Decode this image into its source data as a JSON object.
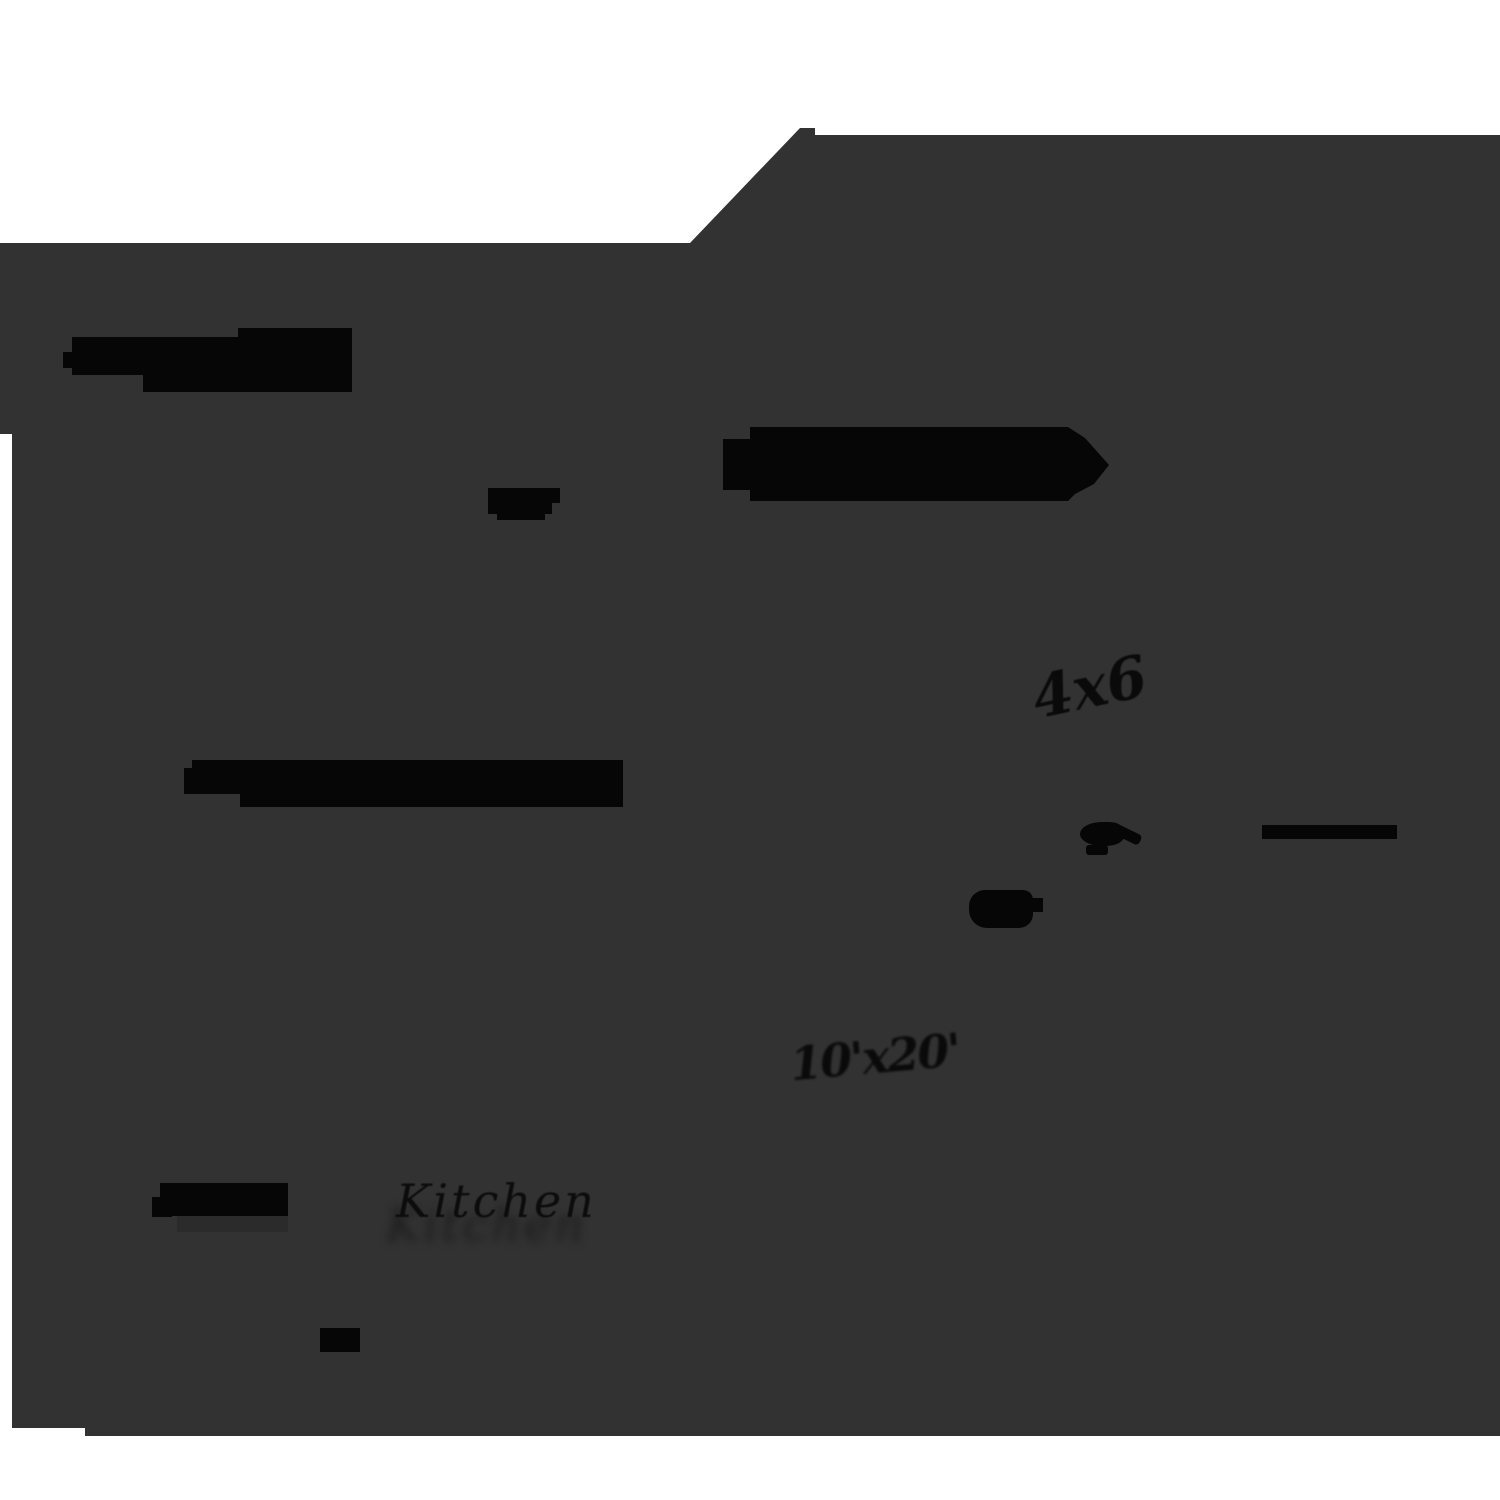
{
  "scene": {
    "description": "Thresholded silhouette scan of a hand-sketched floor plan",
    "background_color": "#ffffff",
    "sheet_color": "#323232",
    "ink_color": "#060606"
  },
  "labels": {
    "kitchen": "Kitchen",
    "dimension_note": "4x6",
    "size_note": "10'x20'"
  }
}
